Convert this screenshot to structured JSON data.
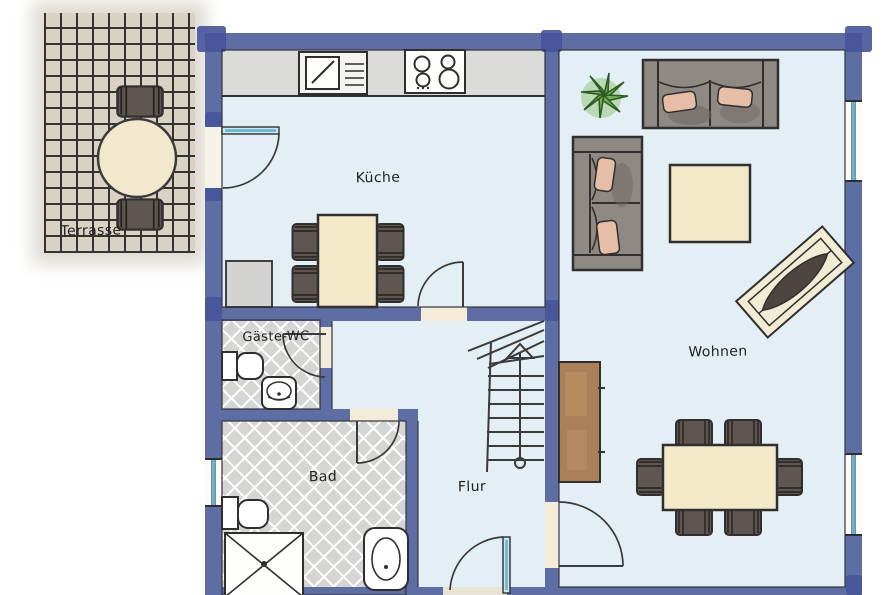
{
  "plan": {
    "type": "floorplan",
    "rooms": {
      "terrasse": {
        "label": "Terrasse"
      },
      "kueche": {
        "label": "Küche"
      },
      "gaeste_wc": {
        "label": "Gäste-WC"
      },
      "bad": {
        "label": "Bad"
      },
      "flur": {
        "label": "Flur"
      },
      "wohnen": {
        "label": "Wohnen"
      }
    },
    "colors": {
      "wall": "#5e6da3",
      "wall_dark": "#46549b",
      "floor": "#e4eef5",
      "tile": "#d5d5d3",
      "counter": "#dbdbd7",
      "wood_cream": "#f3e9c8",
      "chair": "#5f5651",
      "sofa": "#8f8984",
      "pillow": "#e6bda6",
      "plant": "#6fae53",
      "sideboard": "#ab7f57",
      "terrace_paving": "#d9d2c5",
      "glazing": "#5fb7d4",
      "ink": "#2f2f2f"
    },
    "icons": [
      "terrace-table",
      "terrace-chair",
      "kitchen-sink",
      "stove",
      "kitchen-table",
      "chair",
      "sofa",
      "coffee-table",
      "plant",
      "lounger",
      "sideboard",
      "dining-table",
      "stairs",
      "toilet",
      "hand-basin",
      "shower",
      "door-arc",
      "window"
    ]
  }
}
